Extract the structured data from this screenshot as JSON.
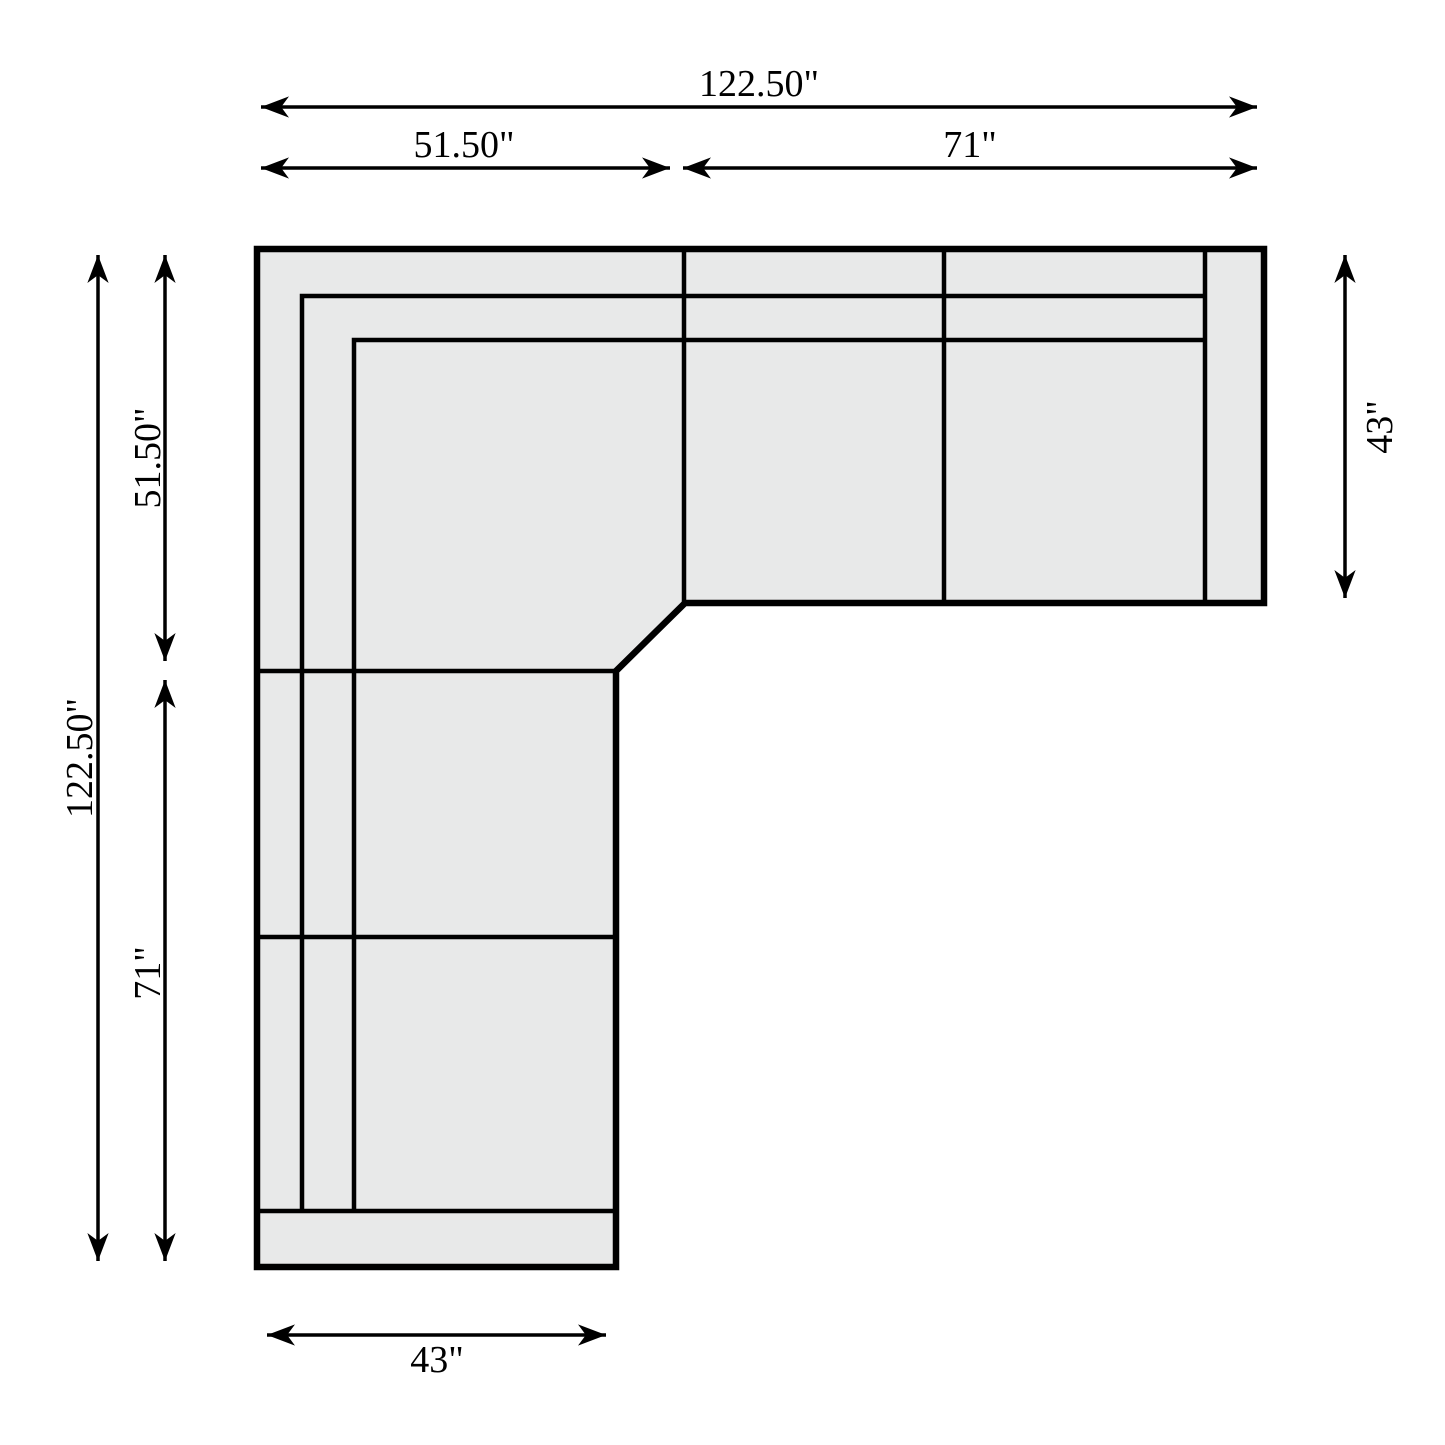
{
  "colors": {
    "background": "#ffffff",
    "line": "#000000",
    "sofa_fill": "#e8e9e9"
  },
  "diagram": {
    "type": "sectional-sofa-floorplan",
    "dimensions": {
      "overall_width": "122.50\"",
      "corner_section_width": "51.50\"",
      "right_run_width": "71\"",
      "overall_depth": "122.50\"",
      "corner_section_depth": "51.50\"",
      "left_run_depth": "71\"",
      "sofa_run_depth": "43\"",
      "left_leg_width": "43\""
    }
  }
}
